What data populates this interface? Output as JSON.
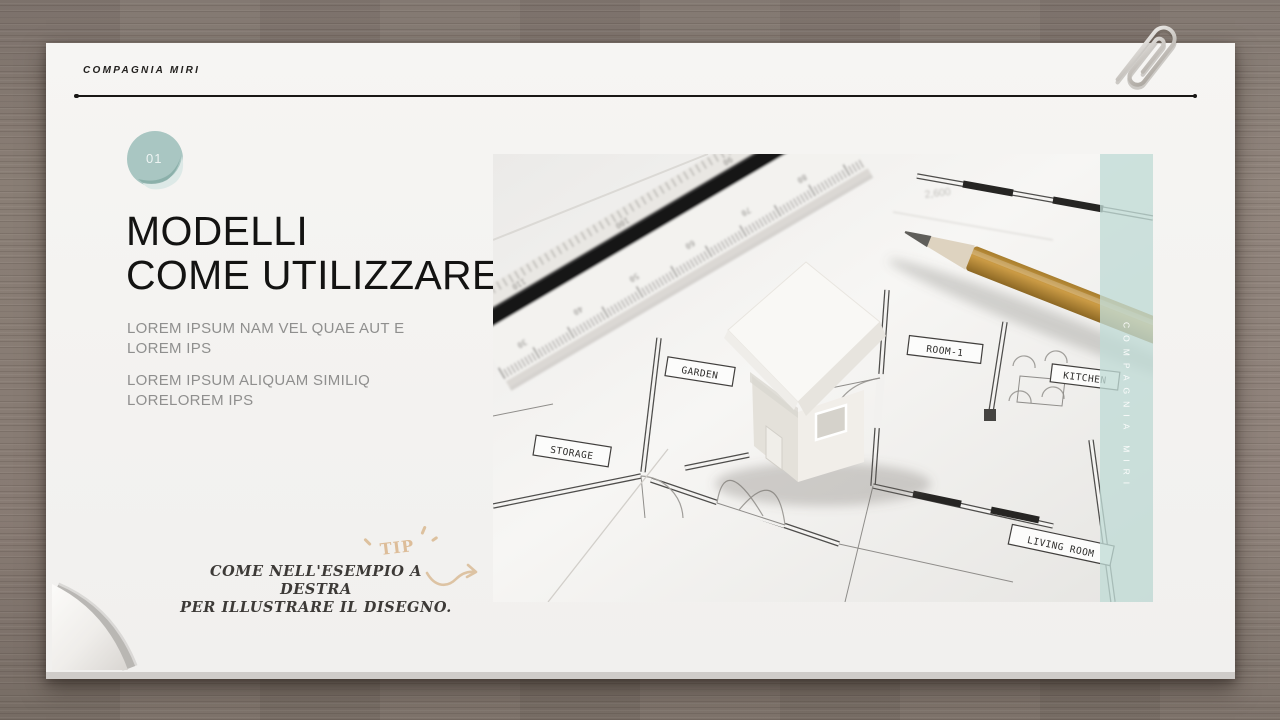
{
  "header": {
    "brand": "COMPAGNIA MIRI"
  },
  "badge": {
    "number": "01"
  },
  "title": {
    "line1": "MODELLI",
    "line2": "COME UTILIZZARE"
  },
  "body": {
    "p1_line1": "LOREM IPSUM NAM VEL QUAE AUT E",
    "p1_line2": "LOREM IPS",
    "p2_line1": "LOREM IPSUM ALIQUAM SIMILIQ",
    "p2_line2": "LORELOREM IPS"
  },
  "tip": {
    "label": "TIP",
    "line1": "COME NELL'ESEMPIO A DESTRA",
    "line2": "PER ILLUSTRARE IL DISEGNO."
  },
  "photo": {
    "room_labels": {
      "garden": "GARDEN",
      "room1": "ROOM-1",
      "kitchen": "KITCHEN",
      "storage": "STORAGE",
      "living_room": "LIVING ROOM"
    },
    "dimension_label": "2,600",
    "side_tab": "COMPAGNIA MIRI",
    "ruler_top": [
      "110",
      "100",
      "90"
    ],
    "ruler_bottom": [
      "30",
      "40",
      "50",
      "60",
      "70",
      "80"
    ]
  },
  "colors": {
    "accent_teal": "#a9c6c2",
    "stripe_teal": "#c0dbd6",
    "tan_accent": "#ddbd99",
    "wood_desk": "#8a7e76",
    "paper": "#f5f4f2",
    "title_ink": "#131312",
    "body_gray": "#8f8f8e"
  }
}
